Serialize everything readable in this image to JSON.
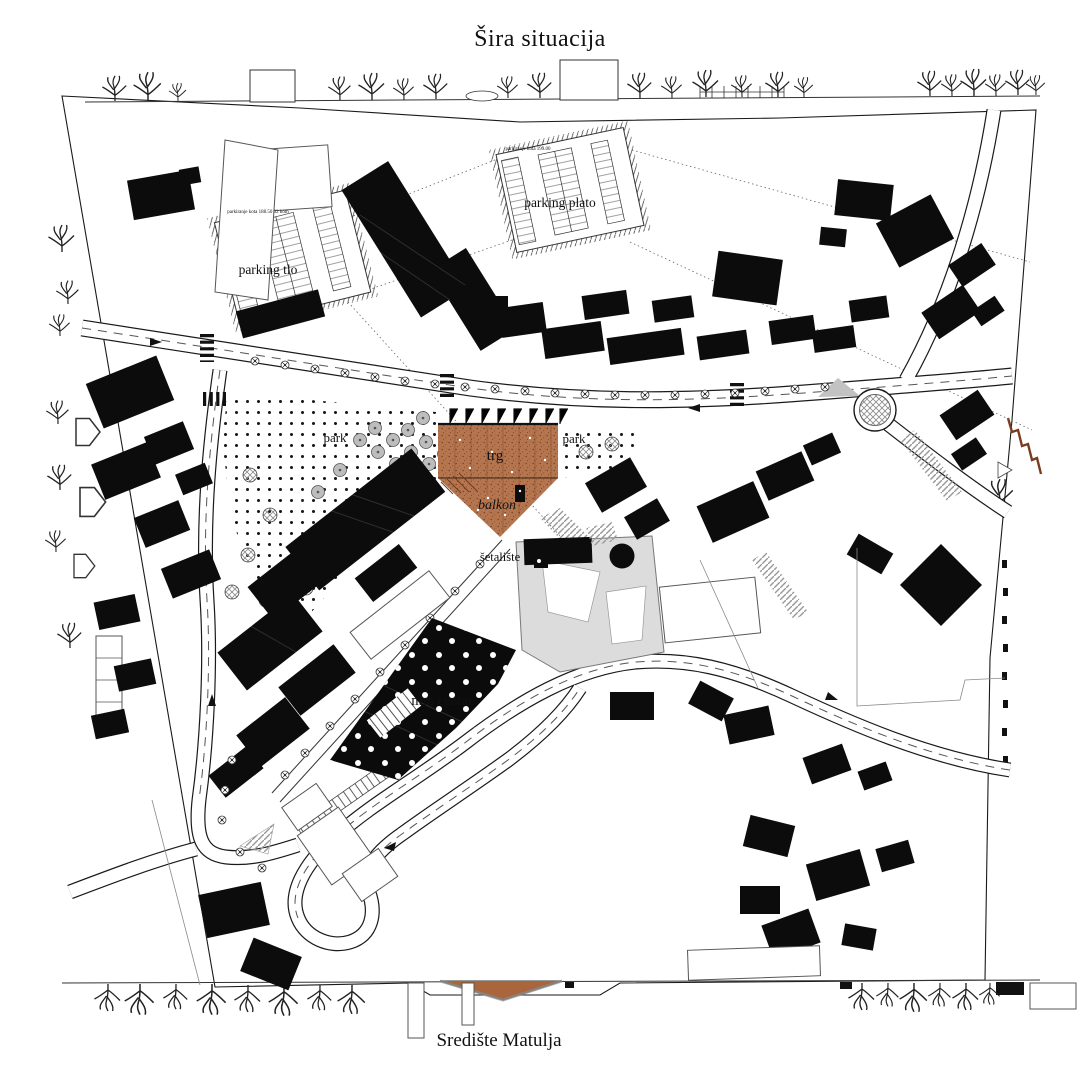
{
  "title": {
    "text": "Šira situacija"
  },
  "subtitle": {
    "text": "Središte Matulja"
  },
  "labels": {
    "parking_plato": "parking plato",
    "parking_tlo": "parking tlo",
    "park_left": "park",
    "park_right": "park",
    "trg": "trg",
    "balkon": "balkon",
    "setaliste": "šetalište",
    "mm_centar": "mm centar",
    "note_plato": "parkiranje kota 199.00",
    "note_tlo": "parkiranje kota 188.50 32 kom"
  },
  "colors": {
    "plaza_fill": "#b5754f",
    "plaza_dark": "#7a4526",
    "section_fill": "#a9663d",
    "rust": "#7a3b1e",
    "ink": "#111111"
  }
}
